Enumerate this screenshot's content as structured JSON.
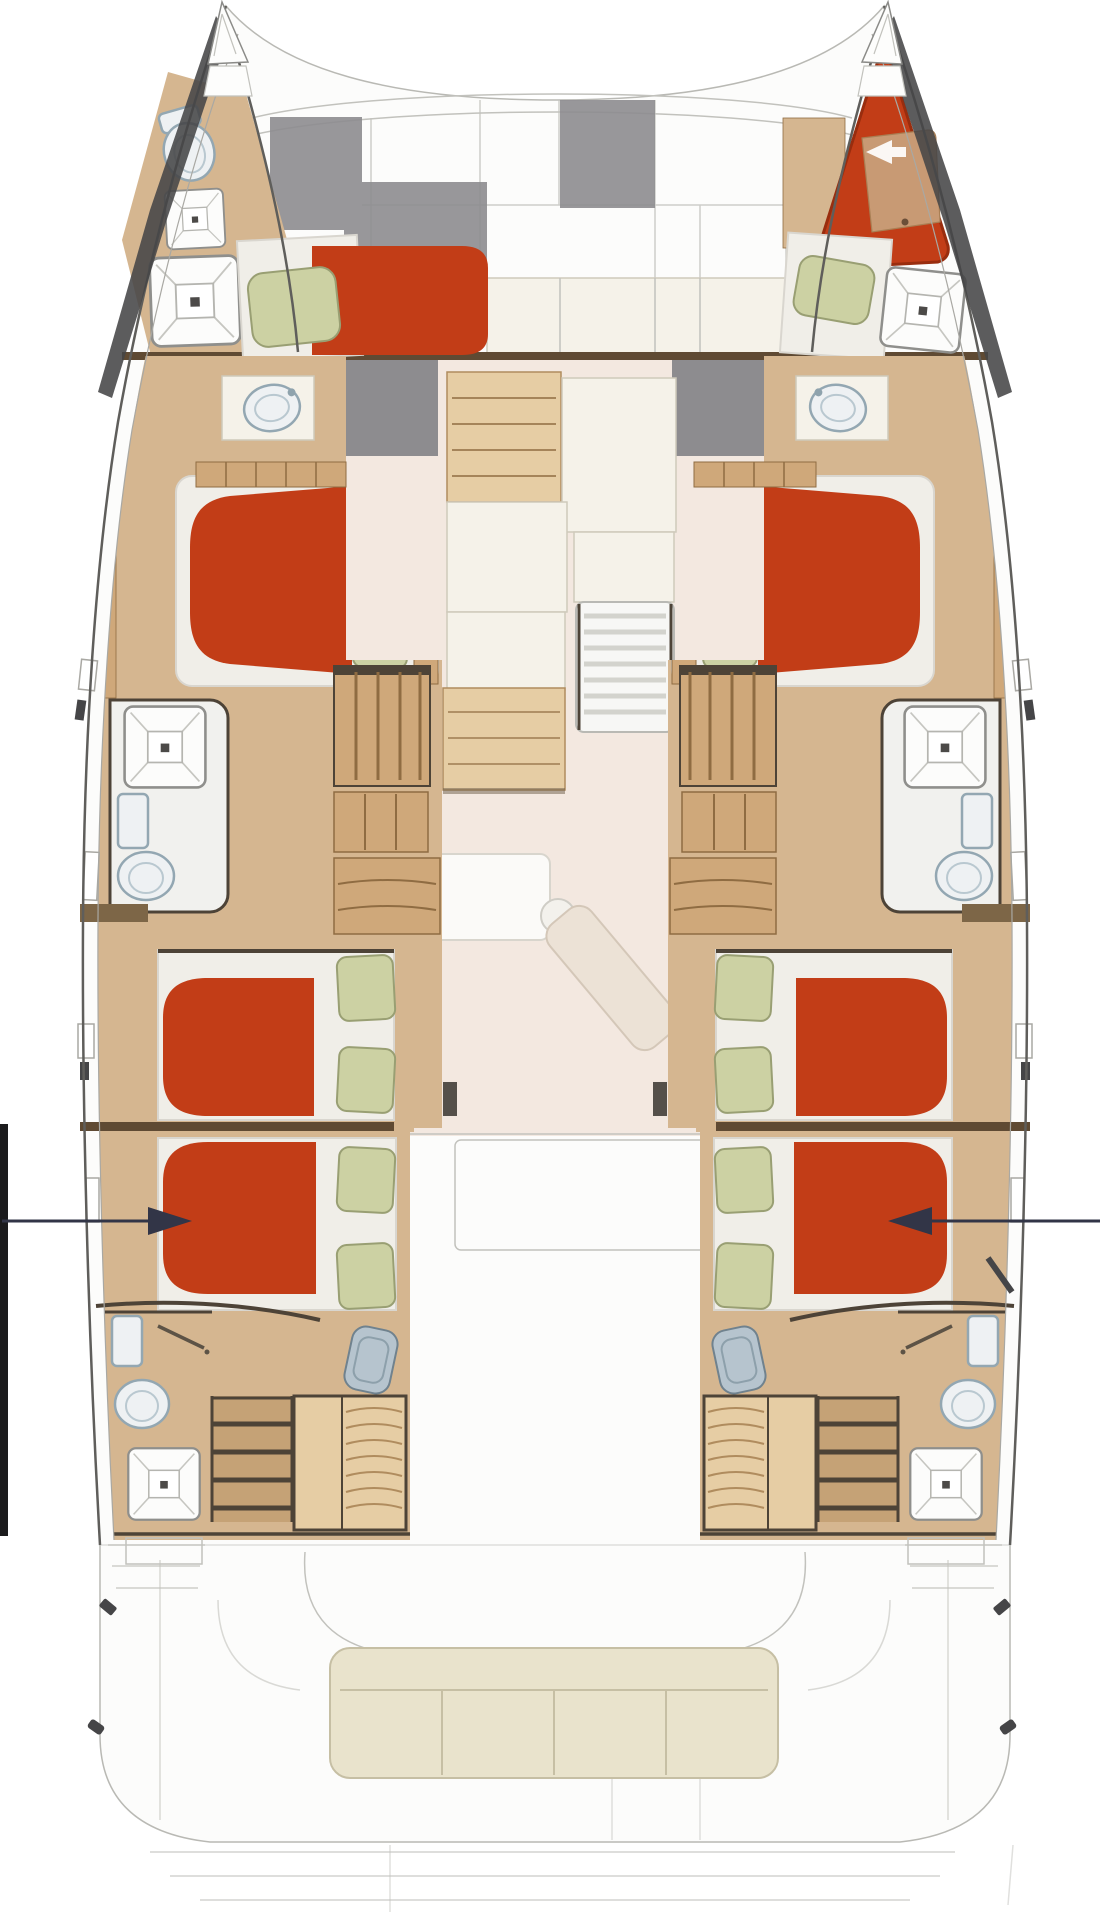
{
  "document": {
    "type": "floor-plan",
    "subject": "Catamaran accommodation deck plan, top view",
    "orientation": "bow-up",
    "visible_text": []
  },
  "colors": {
    "page_bg": "#ffffff",
    "deck_white": "#fcfcfb",
    "deck_line": "#c2c2bd",
    "hull_stroke": "#5f5e5b",
    "hull_inner_line": "#a9a8a3",
    "charcoal": "#454547",
    "bulkhead_brown": "#5f4a33",
    "wall_dark": "#4d4337",
    "floor_tan": "#d5b690",
    "floor_tan_dark": "#c5a276",
    "wood": "#cfa87a",
    "wood_dark": "#8f6c42",
    "wood_light": "#e6cda4",
    "saloon_floor": "#f3e8e0",
    "cream_panel": "#f5f2e9",
    "cream_line": "#cfcabb",
    "grey_box": "#8d8c8f",
    "grey_mid": "#b9b7b2",
    "mattress_red": "#c23d17",
    "mattress_red_dark": "#992d0e",
    "berth_tan": "#c89a74",
    "pillow_green": "#ccd1a3",
    "pillow_edge": "#999f73",
    "sheet": "#f0eee8",
    "sheet_shadow": "#d9d6cf",
    "porcelain": "#eef1f3",
    "porcelain_edge": "#93a7b2",
    "steel_blue": "#b6c4ce",
    "bench_cream": "#e9e3cc",
    "bench_edge": "#c6bfa4",
    "annotation_dark": "#323547",
    "black_bar": "#1b1b1d",
    "grate_white": "#f7f7f5",
    "grate_gap": "#d3d3cd"
  },
  "markers": {
    "left_edge_bar": "black section bar at left margin",
    "port_section_arrow": "arrow pointing into port aft cabin",
    "starboard_section_arrow": "arrow pointing into starboard aft cabin"
  },
  "areas": {
    "foredeck": [
      "bow locker panels",
      "anchor locker grey area",
      "grey deck box",
      "teak locker lid"
    ],
    "port_forepeak": [
      "sea toilet",
      "two deck hatches",
      "crew berth with red mattress and green pillow"
    ],
    "starboard_forepeak": [
      "red skipper area with tan berth and white arrow",
      "crew berth with green pillow",
      "deck hatch"
    ],
    "saloon": [
      "galley counter",
      "galley island",
      "companionway grating",
      "chart cabinet",
      "saloon table",
      "corner seat",
      "angled settee"
    ],
    "port_hull_rooms": [
      "forward head with vanity sink and grey wardrobe",
      "forward double cabin with island bed, red mattress, two green pillows",
      "midship head with shower cubicle, toilet and shelf",
      "companionway steps and drawer units",
      "mid-aft double cabin with red mattress and two green pillows",
      "aft double cabin with red mattress and two green pillows",
      "aft head with toilet, shower, deck hatch, vanity sink, hanging locker and stairs"
    ],
    "starboard_hull_rooms": "mirror of port hull",
    "cockpit": [
      "cushioned bench seat",
      "transom platforms",
      "swim steps"
    ]
  },
  "berth_count": {
    "double_berths": 6,
    "forepeak_berths": 2
  }
}
